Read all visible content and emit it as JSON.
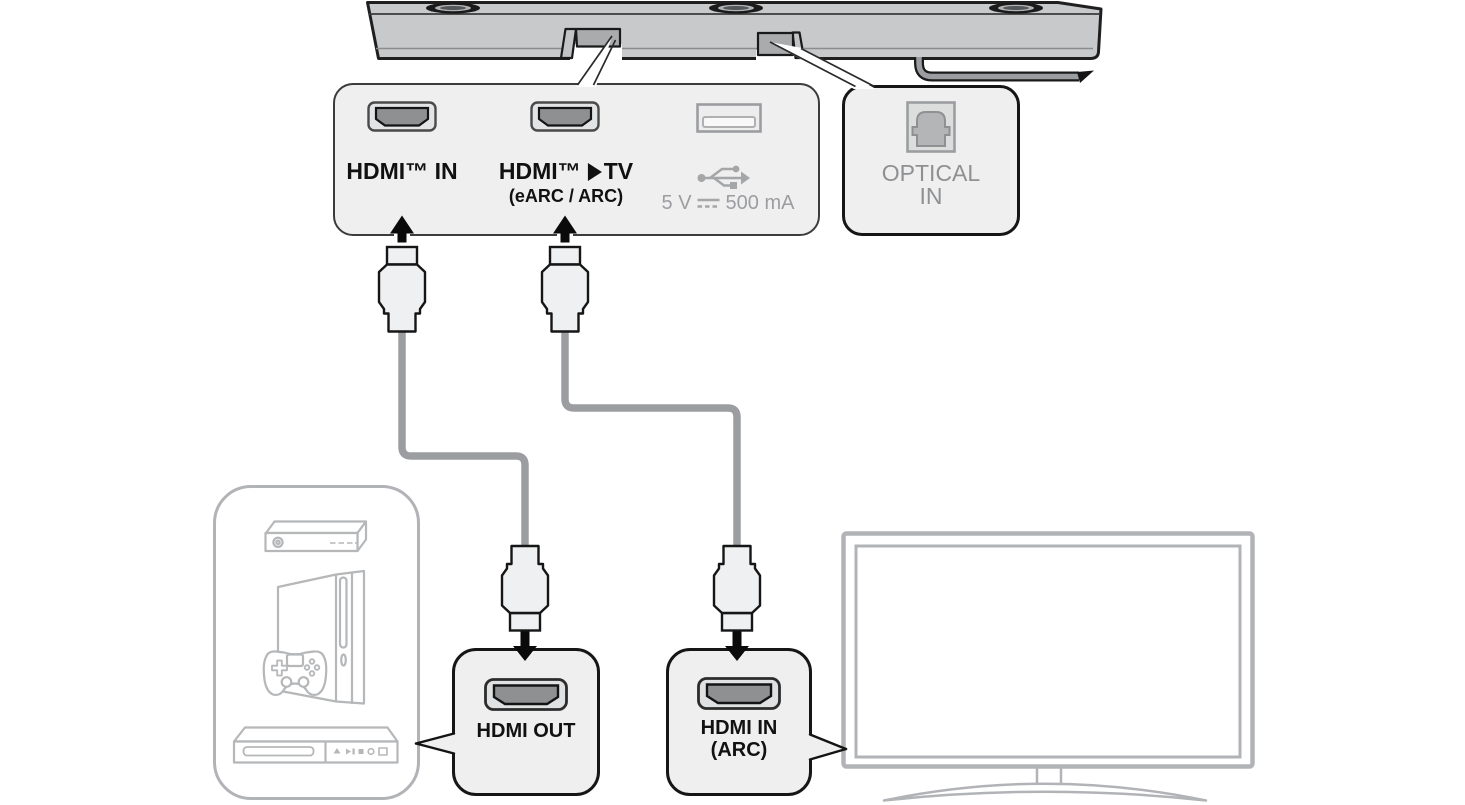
{
  "panels": {
    "main_ports": {
      "hdmi_in_label": "HDMI™ IN",
      "hdmi_tv_label_prefix": "HDMI™",
      "hdmi_tv_label_suffix": "TV",
      "hdmi_tv_sublabel": "(eARC / ARC)",
      "usb_rating_prefix": "5 V",
      "usb_rating_suffix": "500 mA"
    },
    "optical": {
      "label_line1": "OPTICAL",
      "label_line2": "IN"
    },
    "hdmi_out": {
      "label": "HDMI OUT"
    },
    "hdmi_in_arc": {
      "label_line1": "HDMI IN",
      "label_line2": "(ARC)"
    }
  },
  "icons": {
    "hdmi_port": "hdmi-port-icon",
    "usb_port": "usb-port-icon",
    "usb_symbol": "usb-trident-icon",
    "dc_symbol": "dc-voltage-icon",
    "optical_port": "optical-port-icon",
    "arrow_up": "arrow-up-icon",
    "arrow_down": "arrow-down-icon",
    "soundbar": "soundbar-rear-icon",
    "tv": "tv-icon",
    "set_top_box": "set-top-box-icon",
    "game_console": "game-console-icon",
    "gamepad": "gamepad-icon",
    "dvd_player": "dvd-player-icon",
    "hdmi_plug": "hdmi-plug-icon"
  },
  "colors": {
    "background": "#ffffff",
    "panel_bg": "#efefef",
    "panel_border": "#161616",
    "label_text": "#111111",
    "muted_text": "#9b9da0",
    "soundbar_body": "#c7c9cb",
    "cable": "#9b9da0",
    "device_outline": "#b5b7b9",
    "arrow": "#0a0a0a"
  }
}
